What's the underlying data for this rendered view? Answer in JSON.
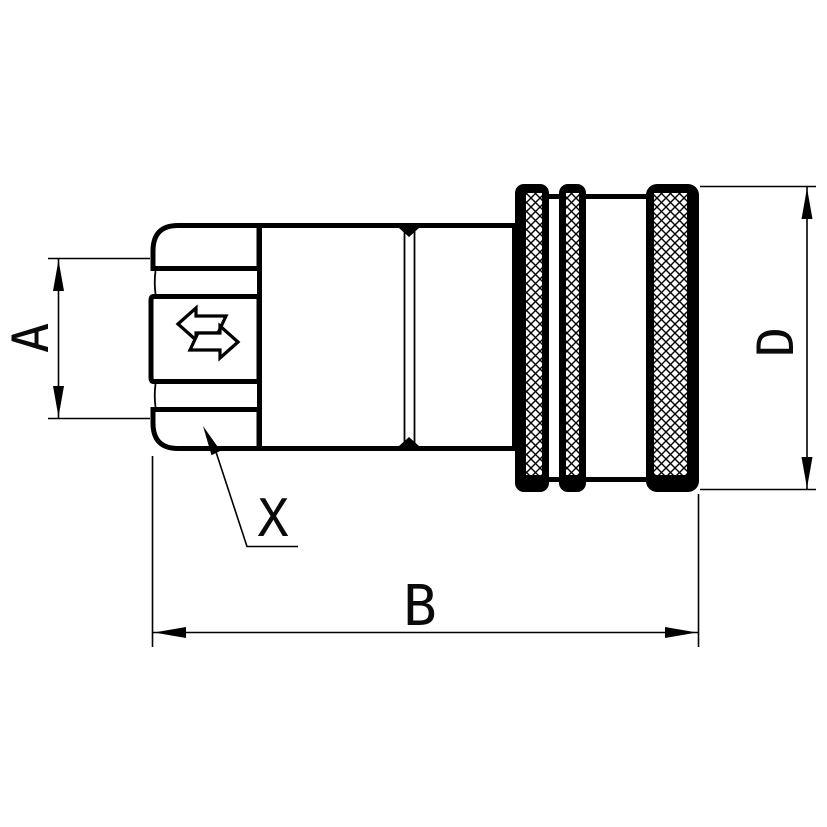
{
  "labels": {
    "a": "A",
    "b": "B",
    "d": "D",
    "x": "X"
  },
  "icons": {
    "swap_arrows": "⇄"
  },
  "colors": {
    "line": "#000000",
    "background": "#ffffff",
    "part_fill": "#ffffff"
  }
}
